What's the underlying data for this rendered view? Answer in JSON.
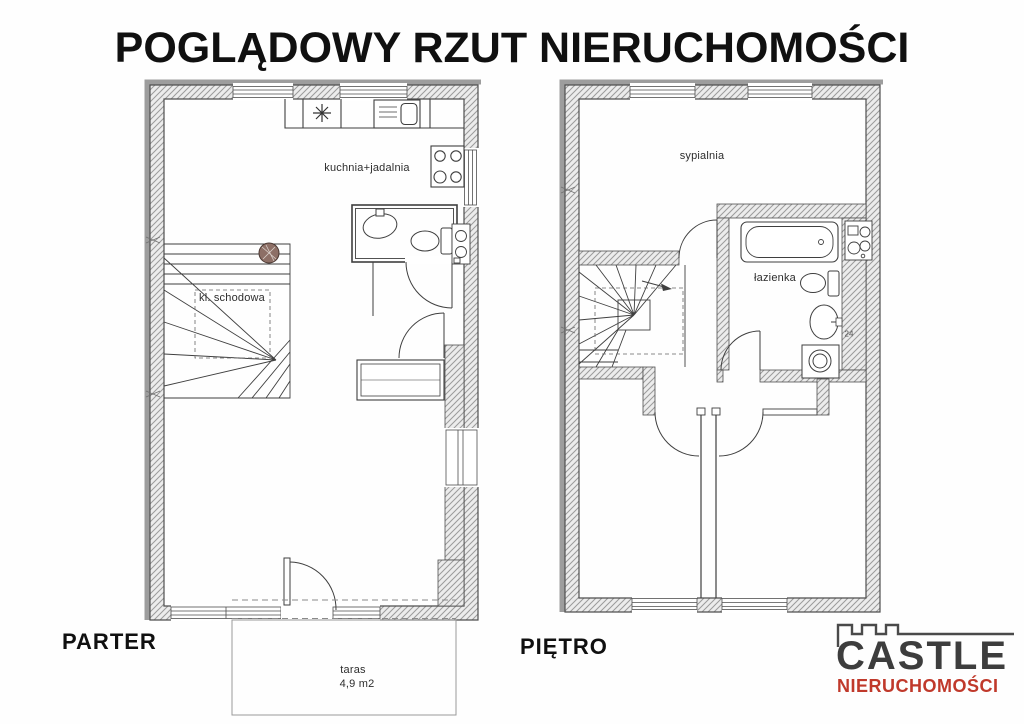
{
  "title": "POGLĄDOWY RZUT NIERUCHOMOŚCI",
  "floors": {
    "parter": {
      "label": "PARTER",
      "rooms": {
        "kitchen_dining": "kuchnia+jadalnia",
        "staircase": "kl. schodowa",
        "terrace": "taras",
        "terrace_area": "4,9 m2"
      }
    },
    "pietro": {
      "label": "PIĘTRO",
      "rooms": {
        "bedroom": "sypialnia",
        "bathroom": "łazienka"
      },
      "wall_dimension": "24"
    }
  },
  "logo": {
    "name": "CASTLE",
    "subtitle": "NIERUCHOMOŚCI",
    "text_color": "#3d3d3d",
    "accent_color": "#c0392b"
  },
  "colors": {
    "wall_hatch_line": "#9b9b9b",
    "wall_fill": "#ececec",
    "drawing_line": "#3f3f3f",
    "stair_column": "#8d6f66"
  }
}
